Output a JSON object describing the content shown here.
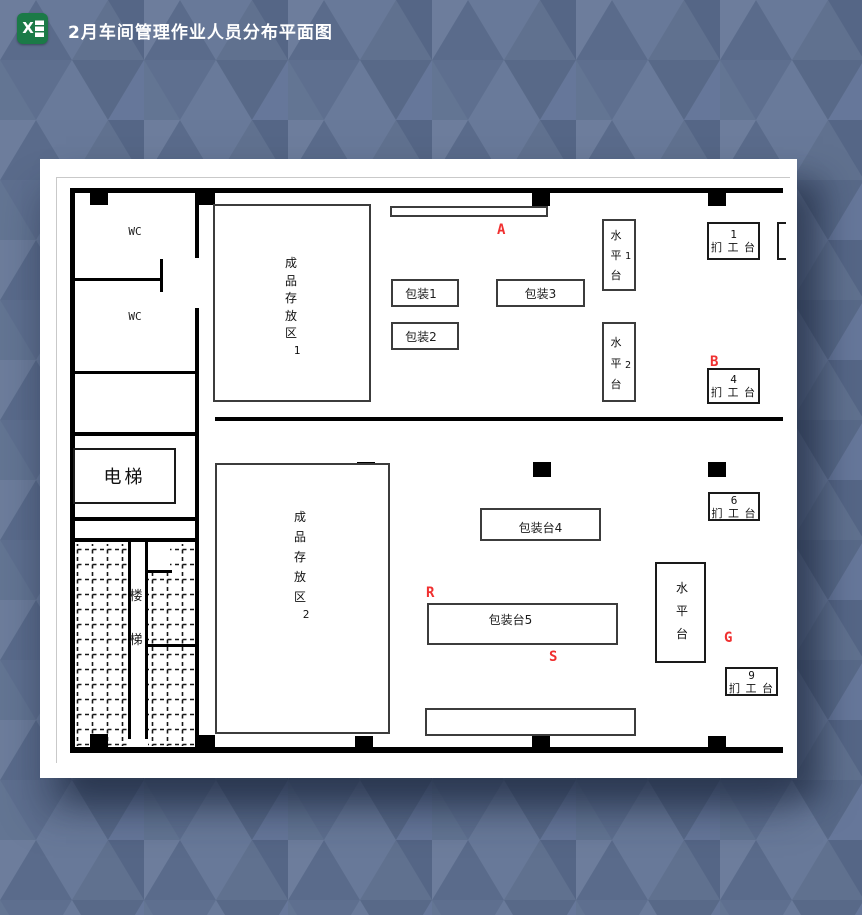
{
  "header": {
    "title": "2月车间管理作业人员分布平面图",
    "icon_letter": "X"
  },
  "plan": {
    "wc1": "WC",
    "wc2": "WC",
    "elevator": "电梯",
    "stairs": {
      "char1": "楼",
      "char2": "梯"
    },
    "storage1": {
      "label": "成品存放区",
      "num": "1"
    },
    "storage2": {
      "label": "成品存放区",
      "num": "2"
    },
    "pack1": "包装1",
    "pack2": "包装2",
    "pack3": "包装3",
    "packdesk4": "包装台4",
    "packdesk5": "包装台5",
    "water1": {
      "label": "水平台",
      "num": "1"
    },
    "water2": {
      "label": "水平台",
      "num": "2"
    },
    "water3": {
      "label": "水平台"
    },
    "table1": {
      "num": "1",
      "label": "扪 工 台"
    },
    "table4": {
      "num": "4",
      "label": "扪 工 台"
    },
    "table6": {
      "num": "6",
      "label": "扪 工 台"
    },
    "table9": {
      "num": "9",
      "label": "扪 工 台"
    },
    "markers": {
      "a": "A",
      "b": "B",
      "r": "R",
      "s": "S",
      "g": "G"
    }
  },
  "colors": {
    "marker_red": "#f03030",
    "wall_black": "#000000",
    "excel_green": "#1b7a47",
    "background_blue": "#66779a",
    "canvas_white": "#ffffff"
  }
}
